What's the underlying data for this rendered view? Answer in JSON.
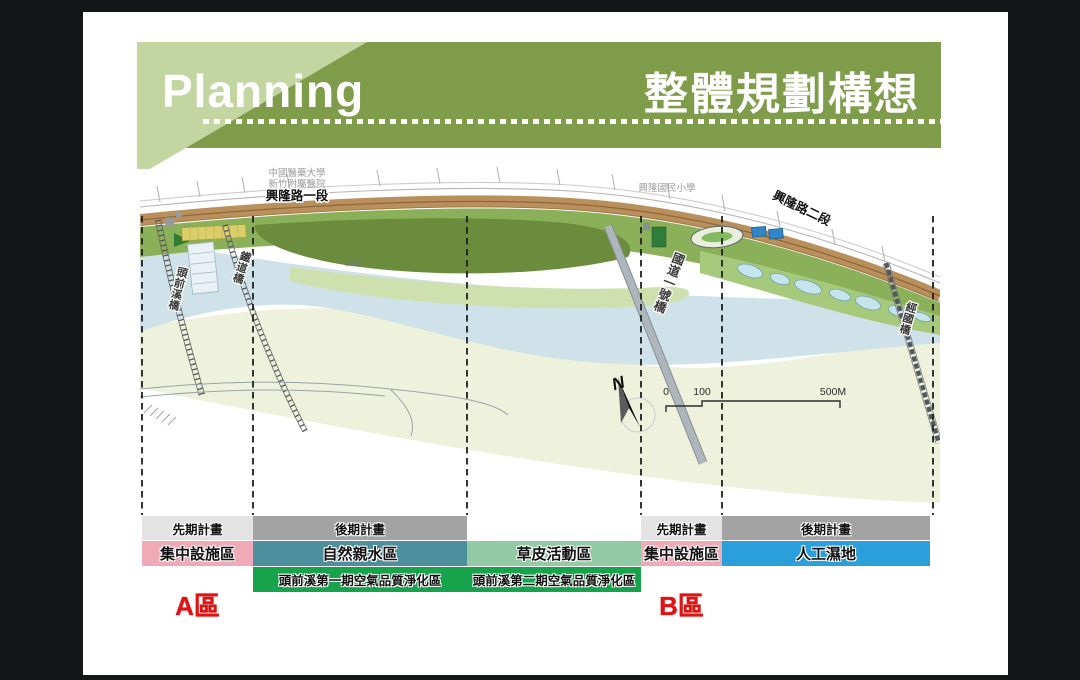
{
  "slide": {
    "background_color": "#141618",
    "paper_color": "#ffffff"
  },
  "header": {
    "title_en": "Planning",
    "title_zh": "整體規劃構想",
    "banner_color": "#7e9c4a",
    "banner_accent_color": "#c3d6a2"
  },
  "map": {
    "landmark_hospital_line1": "中國醫藥大學",
    "landmark_hospital_line2": "新竹附屬醫院",
    "road_section1_label": "興隆路一段",
    "landmark_school": "興隆國民小學",
    "road_section2_label": "興隆路二段",
    "bridge_touqian_label": "頭前溪橋",
    "bridge_railway_label": "鐵道橋",
    "bridge_highway_label": "國道一號橋",
    "bridge_jingguo_label": "經國橋",
    "river_label": "頭前溪",
    "compass_label": "N",
    "scale_tick_0": "0",
    "scale_tick_100": "100",
    "scale_tick_end": "500M",
    "river_color": "#cfe2ea",
    "bank_green_color": "#8bb05a",
    "road_color": "#b98f5c"
  },
  "zones": {
    "marker_a": "A區",
    "marker_b": "B區",
    "columns": [
      {
        "phase": "先期計畫",
        "phase_color": "#e3e3e3",
        "zone": "集中設施區",
        "zone_color": "#f0a9b7"
      },
      {
        "phase": "後期計畫",
        "phase_color": "#a3a3a3",
        "zone": "自然親水區",
        "zone_color": "#4d8f9d",
        "sub_zone": "頭前溪第一期空氣品質淨化區",
        "sub_zone_color": "#17a24c"
      },
      {
        "phase": "",
        "zone": "草皮活動區",
        "zone_color": "#92cba3",
        "sub_zone": "頭前溪第二期空氣品質淨化區",
        "sub_zone_color": "#17a24c"
      },
      {
        "phase": "先期計畫",
        "phase_color": "#e3e3e3",
        "zone": "集中設施區",
        "zone_color": "#f0a9b7"
      },
      {
        "phase": "後期計畫",
        "phase_color": "#a3a3a3",
        "zone": "人工濕地",
        "zone_color": "#2b9fd9"
      }
    ]
  }
}
